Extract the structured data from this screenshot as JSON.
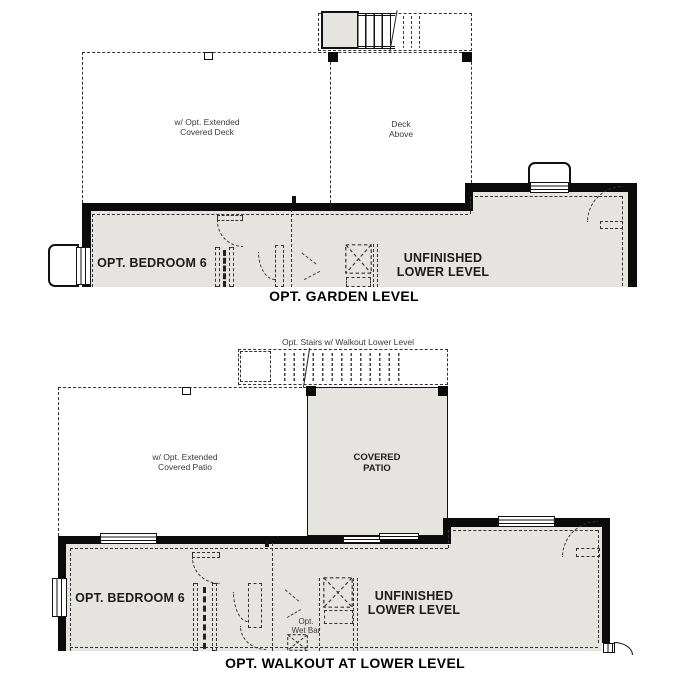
{
  "colors": {
    "wall": "#0b0b0b",
    "floor_fill": "#e6e4e1",
    "dashed_line": "#333333"
  },
  "plans": [
    {
      "id": "garden-level",
      "title": "OPT. GARDEN LEVEL",
      "labels": {
        "deck_extended_line1": "w/ Opt. Extended",
        "deck_extended_line2": "Covered Deck",
        "deck_above_line1": "Deck",
        "deck_above_line2": "Above",
        "bedroom": "OPT. BEDROOM 6",
        "unfinished_line1": "UNFINISHED",
        "unfinished_line2": "LOWER LEVEL"
      }
    },
    {
      "id": "walkout-lower-level",
      "title": "OPT. WALKOUT AT LOWER LEVEL",
      "labels": {
        "stairs_note": "Opt. Stairs w/ Walkout Lower Level",
        "patio_extended_line1": "w/ Opt. Extended",
        "patio_extended_line2": "Covered Patio",
        "covered_patio_line1": "COVERED",
        "covered_patio_line2": "PATIO",
        "bedroom": "OPT. BEDROOM 6",
        "unfinished_line1": "UNFINISHED",
        "unfinished_line2": "LOWER LEVEL",
        "wet_bar_line1": "Opt.",
        "wet_bar_line2": "Wet Bar"
      }
    }
  ]
}
